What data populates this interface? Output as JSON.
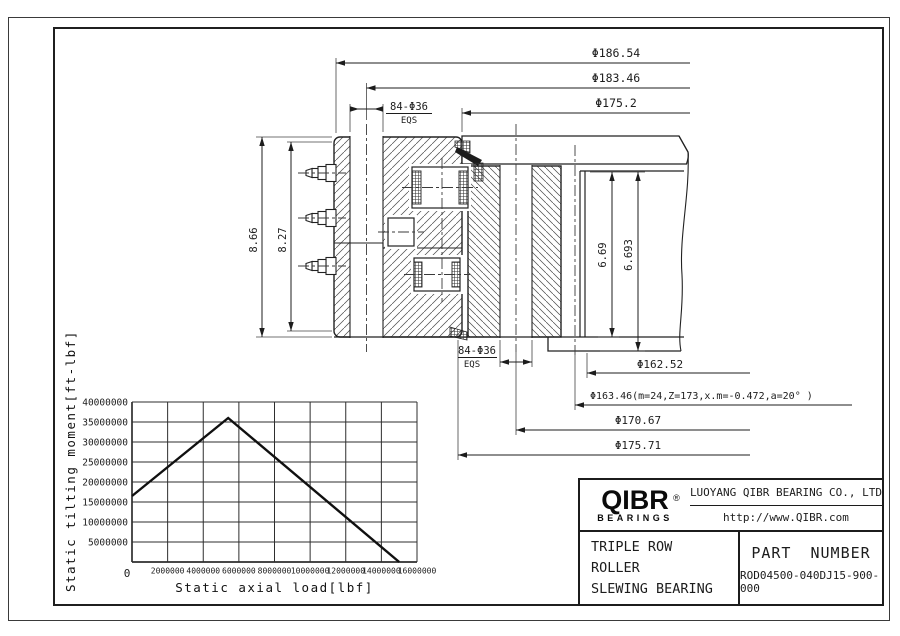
{
  "drawing": {
    "dims": {
      "d186": "Φ186.54",
      "d183": "Φ183.46",
      "d175_2": "Φ175.2",
      "bolt84": "84-Φ36",
      "eqs": "EQS",
      "h866": "8.66",
      "h827": "8.27",
      "g669": "6.69",
      "g6693": "6.693",
      "d16252": "Φ162.52",
      "gearspec": "Φ163.46(m=24,Z=173,x.m=-0.472,a=20° )",
      "d17067": "Φ170.67",
      "d17571": "Φ175.71"
    }
  },
  "chart_data": {
    "type": "line",
    "title": "",
    "xlabel": "Static axial load[lbf]",
    "ylabel": "Static tilting moment[ft-lbf]",
    "xlim": [
      0,
      16000000
    ],
    "ylim": [
      0,
      40000000
    ],
    "x_ticks": [
      0,
      2000000,
      4000000,
      6000000,
      8000000,
      10000000,
      12000000,
      14000000,
      16000000
    ],
    "y_ticks": [
      0,
      5000000,
      10000000,
      15000000,
      20000000,
      25000000,
      30000000,
      35000000,
      40000000
    ],
    "grid": true,
    "legend_position": "none",
    "series": [
      {
        "name": "static-capacity-curve",
        "x": [
          0,
          5400000,
          15000000
        ],
        "y": [
          16500000,
          36000000,
          0
        ]
      }
    ]
  },
  "title_block": {
    "logo": {
      "brand": "QIBR",
      "registered": "®",
      "sub": "BEARINGS"
    },
    "company": "LUOYANG QIBR BEARING CO., LTD",
    "website": "http://www.QIBR.com",
    "product_line1": "TRIPLE ROW",
    "product_line2": "ROLLER",
    "product_line3": "SLEWING BEARING",
    "part_number_label": "PART NUMBER",
    "part_number": "ROD04500-040DJ15-900-000"
  },
  "colors": {
    "line": "#1c1c1c",
    "hatch": "#4a4a4a",
    "background": "#ffffff"
  }
}
